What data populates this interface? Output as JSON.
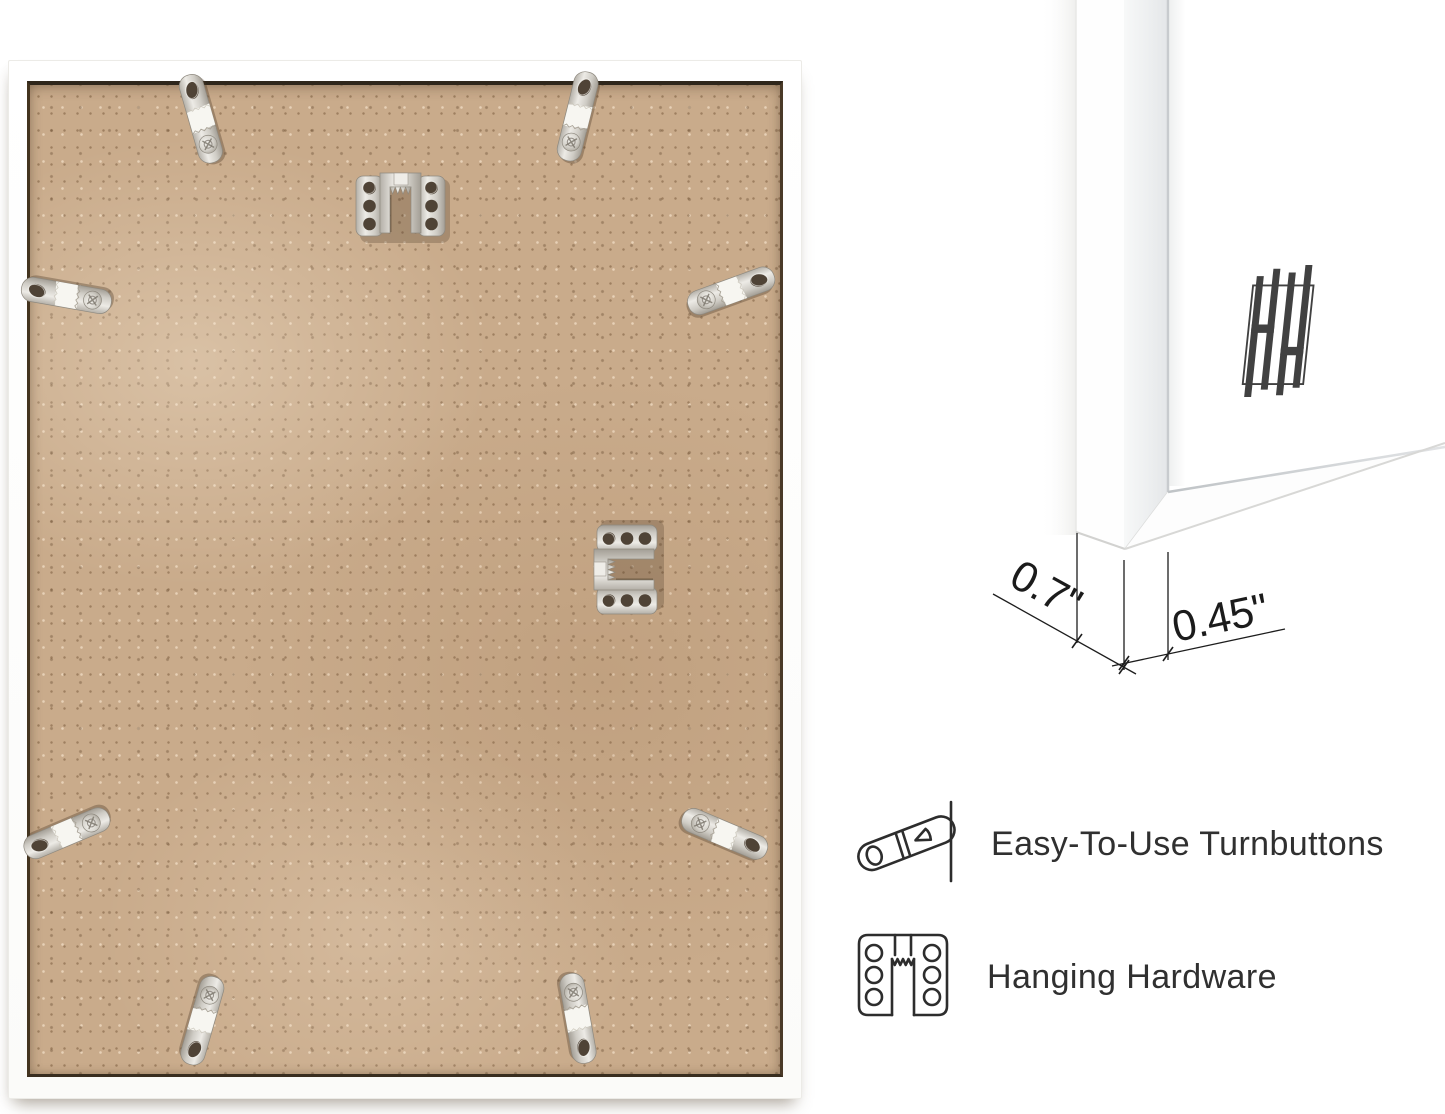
{
  "photo": {
    "subject": "frame-back-with-hardware",
    "board_color": "#c9ab8b",
    "frame_color": "#ffffff",
    "turnbutton_count": 8,
    "sawtooth_hanger_count": 2
  },
  "corner_view": {
    "logo_icon": "hh-monogram-logo",
    "dimensions": {
      "side": "0.7\"",
      "face": "0.45\""
    }
  },
  "features": [
    {
      "icon": "turnbutton-icon",
      "label": "Easy-To-Use Turnbuttons"
    },
    {
      "icon": "hanging-hardware-icon",
      "label": "Hanging Hardware"
    }
  ],
  "colors": {
    "background": "#ffffff",
    "board": "#c9ab8b",
    "metal": "#d8d5cf",
    "legend_ink": "#2d2d2d",
    "dimension_ink": "#1b1b1b",
    "logo": "#414141"
  }
}
